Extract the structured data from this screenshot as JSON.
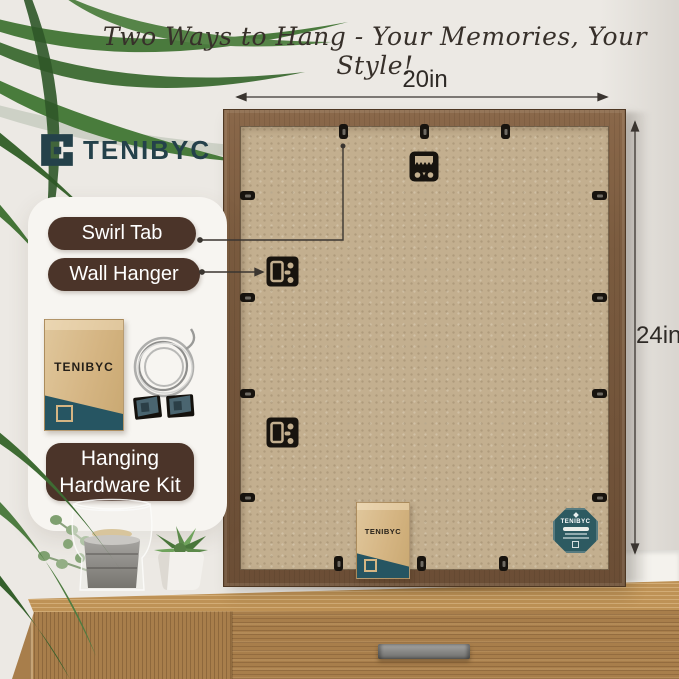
{
  "title": "Two Ways to Hang - Your Memories, Your Style!",
  "brand": {
    "name": "TENIBYC"
  },
  "dimensions": {
    "width": "20in",
    "height": "24in"
  },
  "callout_card": {
    "swirl_tab_label": "Swirl Tab",
    "wall_hanger_label": "Wall Hanger",
    "kit_label": "Hanging Hardware Kit",
    "kit_envelope_brand": "TENIBYC"
  },
  "frame_back": {
    "envelope_brand": "TENIBYC",
    "badge_brand": "TENIBYC"
  },
  "colors": {
    "wall": "#ECE9E4",
    "label_pill_brown": "#4B3429",
    "brand_teal": "#24414A",
    "frame_wood_brown": "#7A5B3F",
    "backboard_tan": "#C3AF8F",
    "badge_teal": "#2D5A61",
    "dresser_wood": "#A87E4B",
    "annotation_ink": "#3A3530"
  }
}
